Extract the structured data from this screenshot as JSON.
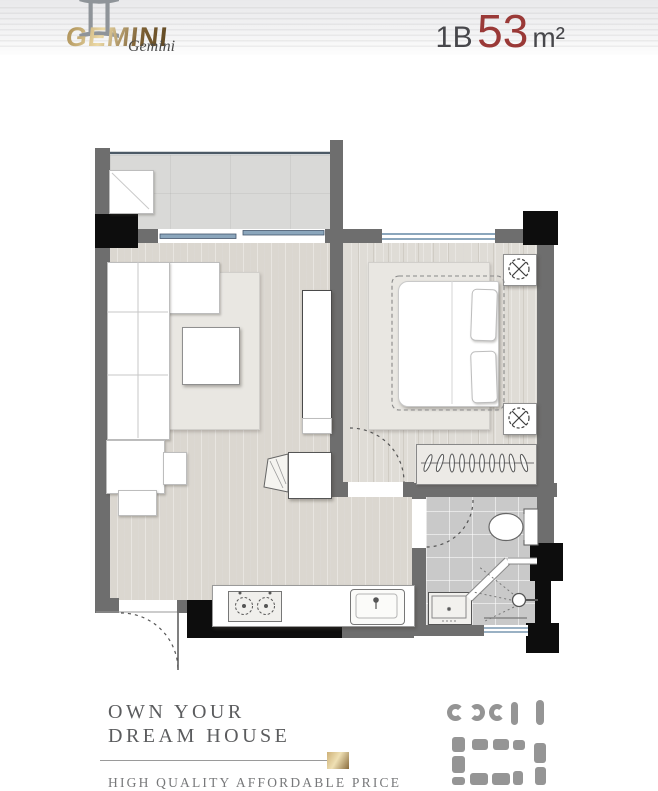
{
  "header": {
    "brand_glyph": "♊",
    "brand_name": "GEMINI",
    "brand_script": "Gemini",
    "unit_type": "1B",
    "unit_area": "53",
    "unit_measure": "m²"
  },
  "footer": {
    "headline_line1": "OWN YOUR",
    "headline_line2": "DREAM HOUSE",
    "tagline": "HIGH QUALITY AFFORDABLE PRICE"
  },
  "palette": {
    "accent_red": "#9a3937",
    "brand_gold": "#b3924f",
    "wall_gray": "#6e6e6e",
    "column_black": "#0d0d0d",
    "window_blue": "#8ba6bc",
    "wood_floor": "#dbd7d0",
    "bath_tile": "#c9c9c9"
  },
  "floorplan": {
    "symbols": [
      "ceiling-lamp-icon",
      "stove-burner-icon",
      "kitchen-sink-icon",
      "bathroom-sink-icon",
      "shower-head-icon",
      "toilet-icon",
      "clothes-hanger-icon",
      "door-swing-arc",
      "window-glazing",
      "sliding-door"
    ]
  }
}
